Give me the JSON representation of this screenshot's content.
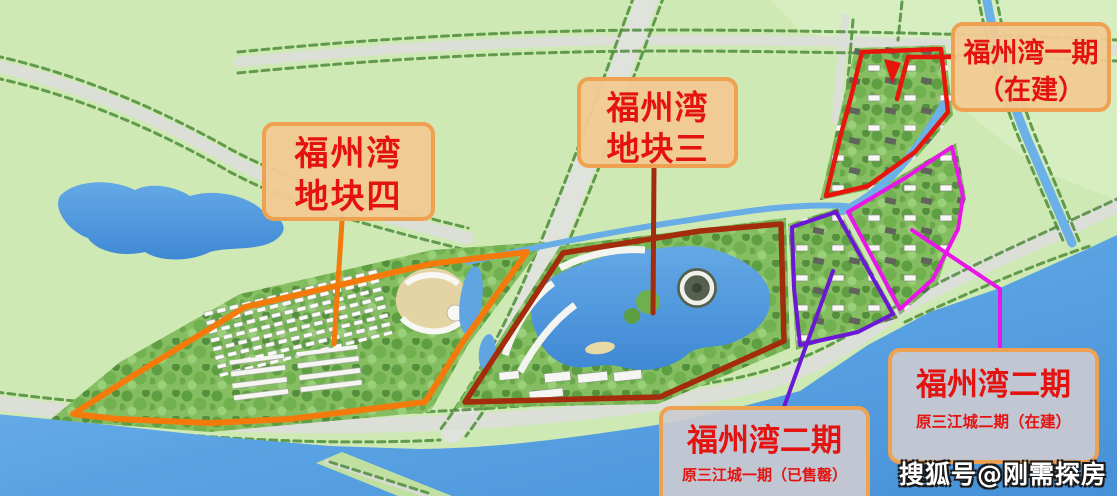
{
  "watermark": "搜狐号@刚需探房",
  "labels": {
    "plot4": {
      "line1": "福州湾",
      "line2": "地块四"
    },
    "plot3": {
      "line1": "福州湾",
      "line2": "地块三"
    },
    "phase1": {
      "line1": "福州湾一期",
      "line2": "（在建）"
    },
    "phase2_sold": {
      "line1": "福州湾二期",
      "line2": "原三江城一期（已售罄）"
    },
    "phase2_building": {
      "line1": "福州湾二期",
      "line2": "原三江城二期（在建）"
    }
  },
  "colors": {
    "plot4_boundary": "#f57a0c",
    "plot3_boundary": "#a32c0d",
    "phase1_boundary": "#e8150d",
    "phase2_sold_boundary": "#6a17d6",
    "phase2_building_boundary": "#e816e8",
    "label_text": "#e41310",
    "label_border": "#efa152",
    "water": "#5aa3e3",
    "field_green": "#cfe9b5"
  }
}
